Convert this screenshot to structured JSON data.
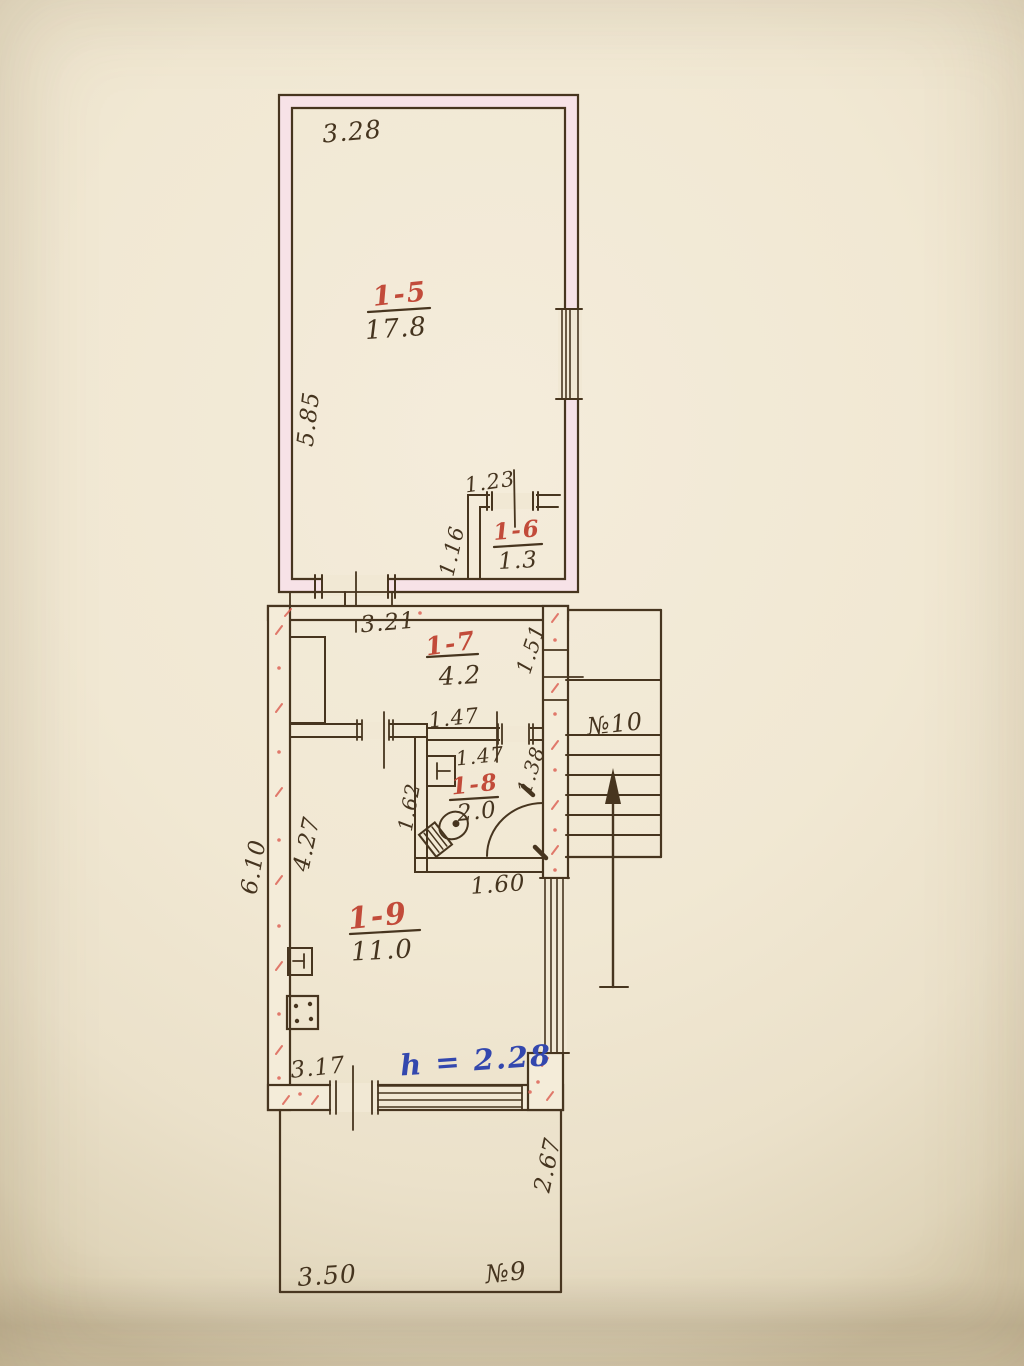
{
  "plan": {
    "title_hint": "hand-drawn floor plan (BTI sheet)",
    "rooms": [
      {
        "number": "1-5",
        "area": "17.8"
      },
      {
        "number": "1-6",
        "area": "1.3"
      },
      {
        "number": "1-7",
        "area": "4.2"
      },
      {
        "number": "1-8",
        "area": "2.0"
      },
      {
        "number": "1-9",
        "area": "11.0"
      }
    ],
    "stairwell_label": "№10",
    "yard_label": "№9",
    "height_note": "h = 2.28",
    "dimensions": {
      "room_1_5_width": "3.28",
      "room_1_5_depth": "5.85",
      "room_1_6_width": "1.23",
      "room_1_6_depth": "1.16",
      "room_1_7_width": "3.21",
      "door_1_7_side": "1.51",
      "room_1_8_top_outer": "1.47",
      "room_1_8_top_inner": "1.47",
      "room_1_8_right": "1.38",
      "room_1_8_left": "1.62",
      "room_1_8_bottom": "1.60",
      "building_left_outer": "6.10",
      "room_1_9_left": "4.27",
      "room_1_9_bottom": "3.17",
      "yard_right": "2.67",
      "yard_bottom": "3.50"
    },
    "colors": {
      "ink": "#47351f",
      "room_label_red": "#c24b3a",
      "note_blue": "#3347ae",
      "wall_tint_pink": "#f7e2e7",
      "wall_hatch_red": "#dd6457",
      "paper": "#f1e8d4"
    }
  }
}
